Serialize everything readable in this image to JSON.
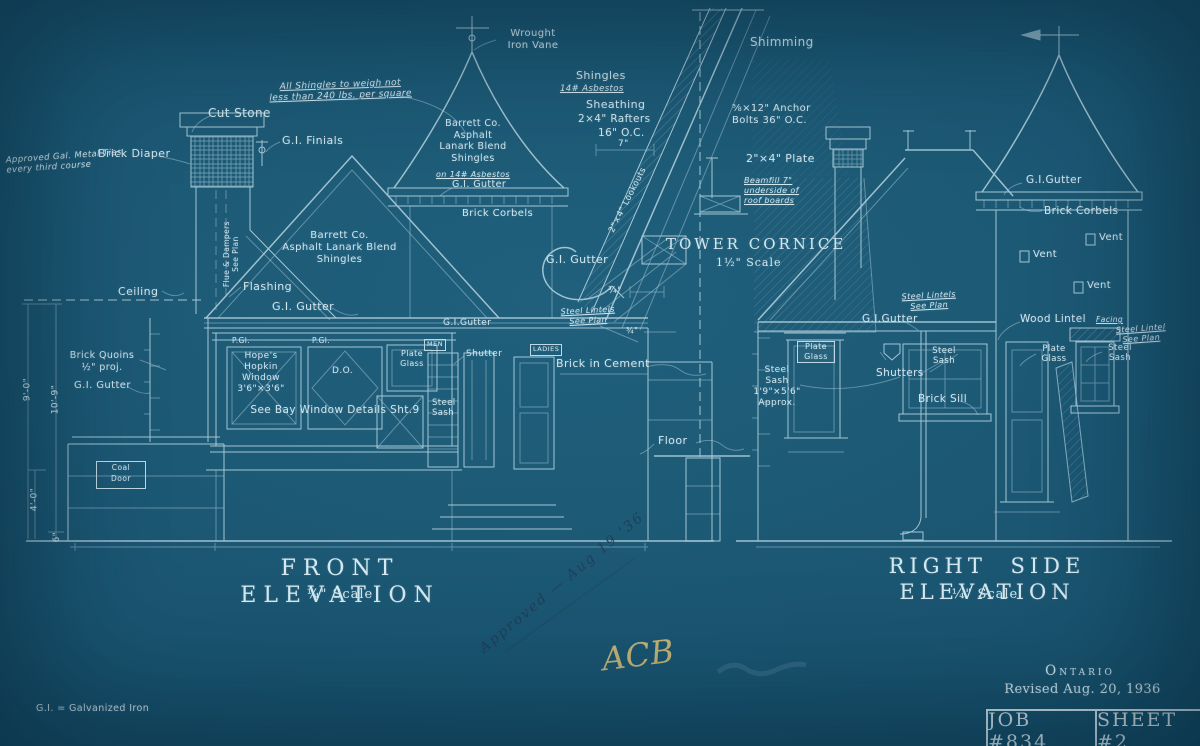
{
  "colors": {
    "background": "#1a5571",
    "ink": "#cfe4ec",
    "pencil": "#233b54",
    "crayon": "#d9c078"
  },
  "general_notes": {
    "shingle_weight": "All Shingles to weigh not\nless than 240 lbs. per square",
    "metal_ties": "Approved Gal. Metal Ties\nevery third course",
    "gi_legend": "G.I. = Galvanized Iron"
  },
  "front_elevation": {
    "title": "FRONT ELEVATION",
    "scale": "¼\" Scale",
    "labels": {
      "cut_stone": "Cut Stone",
      "brick_diaper": "Brick Diaper",
      "gi_finials": "G.I. Finials",
      "wrought_iron_vane": "Wrought\nIron Vane",
      "tower_shingles": "Barrett Co.\nAsphalt\nLanark Blend\nShingles",
      "tower_shingles_em": "on 14# Asbestos",
      "tower_gutter": "G.I. Gutter",
      "tower_corbels": "Brick Corbels",
      "flue_note": "Flue & Dampers\nSee Plan",
      "main_shingles": "Barrett Co.\nAsphalt Lanark Blend\nShingles",
      "flashing": "Flashing",
      "main_gutter": "G.I. Gutter",
      "ceiling": "Ceiling",
      "brick_quoins": "Brick Quoins\n½\" proj.",
      "quoin_gutter": "G.I. Gutter",
      "coal_door": "Coal\nDoor",
      "plate_glass_abbr_1": "P.Gl.",
      "plate_glass_abbr_2": "P.Gl.",
      "hopkin_window": "Hope's\nHopkin\nWindow\n3'6\"×3'6\"",
      "ditto": "D.O.",
      "plate_glass": "Plate\nGlass",
      "bay_note": "See Bay Window Details Sht.9",
      "men_sign": "MEN",
      "ladies_sign": "LADIES",
      "shutter": "Shutter",
      "steel_sash": "Steel\nSash",
      "gutter_right": "G.I.Gutter",
      "steel_lintels": "Steel Lintels\nSee Plan",
      "brick_in_cement": "Brick in Cement",
      "floor": "Floor"
    },
    "dimensions": {
      "ceiling_height": "9'-0\"",
      "overall_height": "10'-9\"",
      "base_height": "4'-0\"",
      "plinth": "6\""
    }
  },
  "tower_cornice_detail": {
    "title": "TOWER CORNICE",
    "scale": "1½\" Scale",
    "labels": {
      "shimming": "Shimming",
      "shingles": "Shingles",
      "shingles_em": "14# Asbestos",
      "sheathing": "Sheathing",
      "rafters": "2×4\" Rafters",
      "rafter_spacing": "16\" O.C.",
      "seven_in": "7\"",
      "anchor_bolts": "⅝×12\" Anchor\nBolts 36\" O.C.",
      "plate": "2\"×4\" Plate",
      "beamfill": "Beamfill 7\"\nunderside of\nroof boards",
      "lookouts": "2\"×4\" Lookouts",
      "gutter": "G.I. Gutter",
      "dim_a": "¾\"",
      "dim_b": "¾\""
    }
  },
  "right_elevation": {
    "title": "RIGHT SIDE ELEVATION",
    "scale": "¼\" Scale",
    "labels": {
      "tower_gutter": "G.I.Gutter",
      "tower_corbels": "Brick Corbels",
      "vent_1": "Vent",
      "vent_2": "Vent",
      "vent_3": "Vent",
      "steel_lintels": "Steel Lintels\nSee Plan",
      "gutter": "G.I.Gutter",
      "plate_glass_1": "Plate\nGlass",
      "steel_sash_note": "Steel\nSash\n1'9\"×5'6\"\nApprox.",
      "steel_sash_1": "Steel\nSash",
      "shutters": "Shutters",
      "brick_sill": "Brick Sill",
      "wood_lintel": "Wood Lintel",
      "facing_em": "Facing",
      "steel_lintel_2": "Steel Lintel\nSee Plan",
      "plate_glass_2": "Plate\nGlass",
      "steel_sash_2": "Steel\nSash"
    }
  },
  "title_block": {
    "region": "Ontario",
    "revised": "Revised Aug. 20, 1936",
    "job_number": "JOB #834",
    "sheet_number": "SHEET #2"
  },
  "handwritten": {
    "approval_note": "Approved — Aug 19 '36",
    "initials": "ACB"
  }
}
